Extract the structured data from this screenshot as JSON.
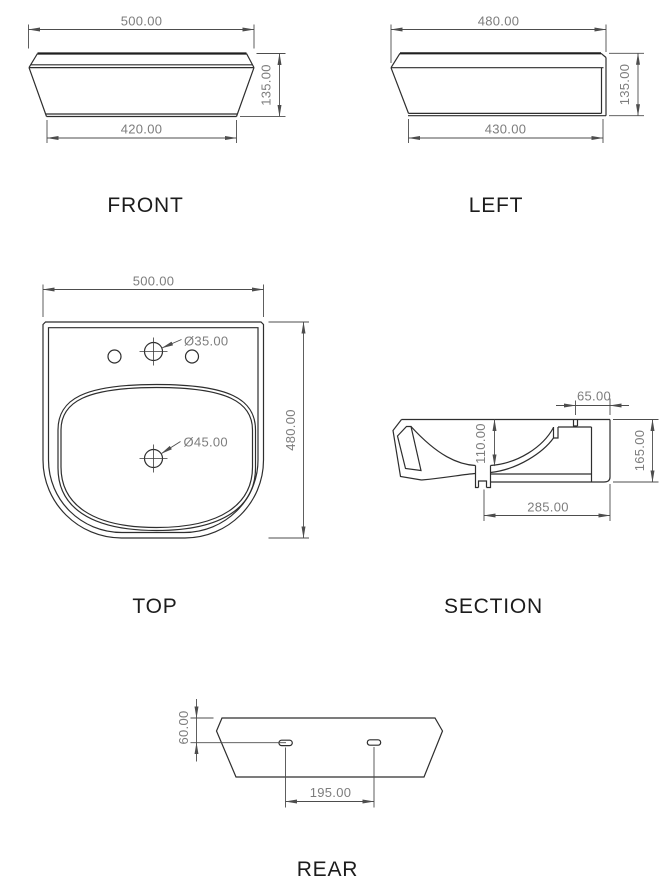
{
  "drawing": {
    "colors": {
      "outline": "#2e2e2e",
      "dimension_lines": "#4d4d4d",
      "dimension_text": "#7d7d7d",
      "label_text": "#1c1c1c",
      "background": "#ffffff"
    },
    "views": {
      "front": {
        "label": "FRONT",
        "dim_width_top": "500.00",
        "dim_height": "135.00",
        "dim_width_bottom": "420.00"
      },
      "left": {
        "label": "LEFT",
        "dim_width_top": "480.00",
        "dim_height": "135.00",
        "dim_width_bottom": "430.00"
      },
      "top": {
        "label": "TOP",
        "dim_width": "500.00",
        "dim_depth": "480.00",
        "dim_faucet_hole": "Ø35.00",
        "dim_drain_hole": "Ø45.00"
      },
      "section": {
        "label": "SECTION",
        "dim_rear_ledge": "65.00",
        "dim_basin_depth": "110.00",
        "dim_height": "165.00",
        "dim_depth": "285.00"
      },
      "rear": {
        "label": "REAR",
        "dim_slot_offset": "60.00",
        "dim_slot_spacing": "195.00"
      }
    }
  }
}
